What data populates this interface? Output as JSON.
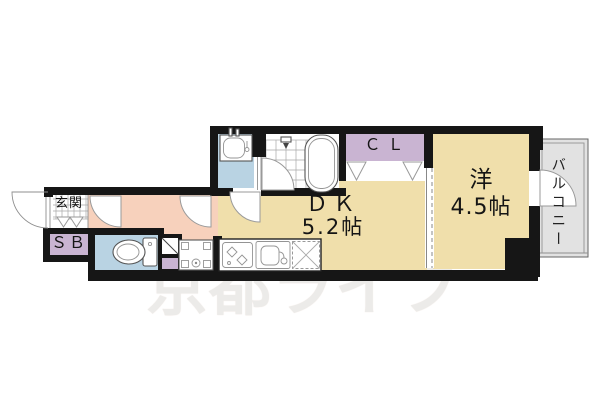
{
  "labels": {
    "genkan": "玄関",
    "shoe_box": "ＳＢ",
    "closet": "ＣＬ",
    "dk_name": "ＤＫ",
    "dk_size": "5.2帖",
    "western_name": "洋",
    "western_size": "4.5帖",
    "balcony": "バルコニー",
    "watermark": "京都ライフ"
  },
  "fixtures": [
    "entry-door-swing",
    "interior-door-swings",
    "toilet",
    "pipe-space",
    "washing-machine-pan",
    "gas-stove",
    "kitchen-sink",
    "refrigerator-space",
    "washbasin",
    "bathtub",
    "shower",
    "closet-folding-doors",
    "balcony-door-swing"
  ],
  "colors": {
    "wall_black": "#161616",
    "room_tan": "#f0dfab",
    "hall_pink": "#f7d1bc",
    "wet_blue": "#b9d3e3",
    "storage_purple": "#c9b4d2",
    "balcony_gray": "#e2e2e2",
    "watermark_gray": "#ecebe9"
  }
}
